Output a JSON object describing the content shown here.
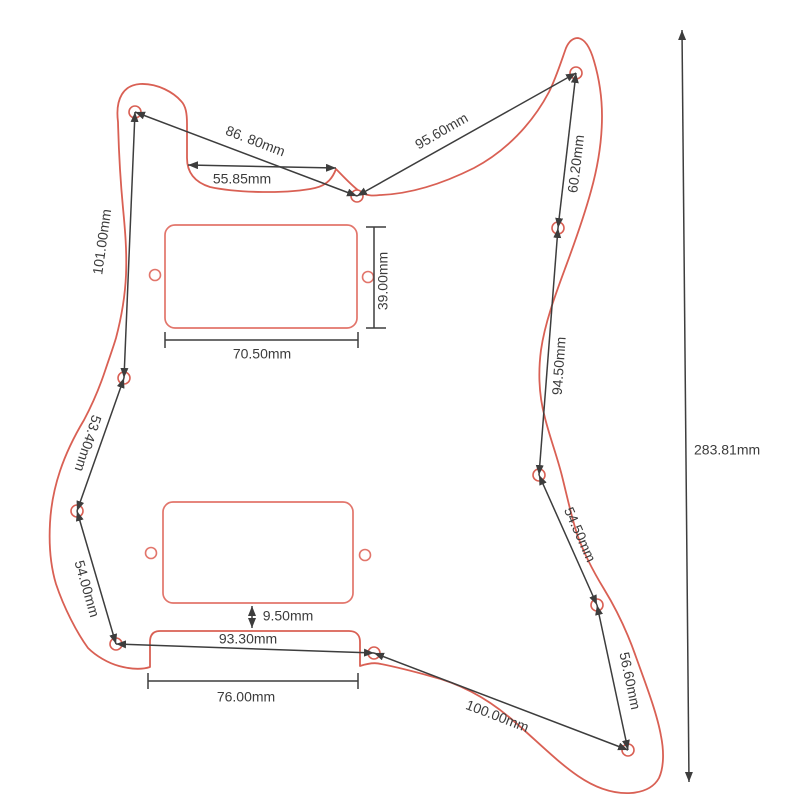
{
  "drawing": {
    "subject": "guitar-pickguard-dimension-diagram",
    "unit": "mm"
  },
  "dims": {
    "dim_86_80": "86. 80mm",
    "dim_55_85": "55.85mm",
    "dim_95_60": "95.60mm",
    "dim_60_20": "60.20mm",
    "dim_101_00": "101.00mm",
    "dim_39_00": "39.00mm",
    "dim_70_50": "70.50mm",
    "dim_94_50": "94.50mm",
    "dim_53_40": "53.40mm",
    "dim_54_50": "54.50mm",
    "dim_54_00": "54.00mm",
    "dim_9_50": "9.50mm",
    "dim_93_30": "93.30mm",
    "dim_56_60": "56.60mm",
    "dim_76_00": "76.00mm",
    "dim_100_00": "100.00mm",
    "dim_283_81": "283.81mm"
  },
  "colors": {
    "outline": "#d96054",
    "cutout": "#e2756b",
    "dimension_line": "#3d3d3d",
    "text": "#3c3c3c",
    "background": "#ffffff"
  }
}
